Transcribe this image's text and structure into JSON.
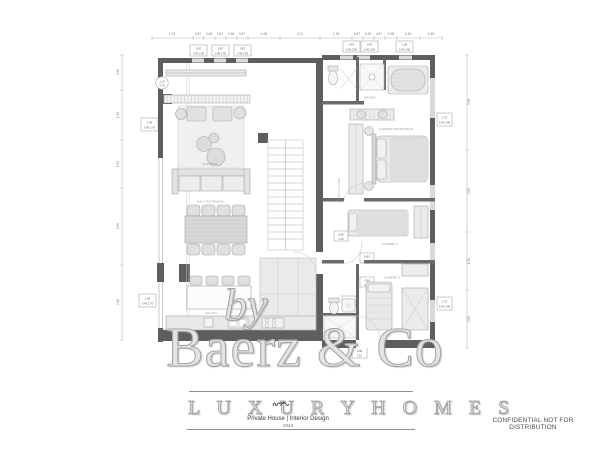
{
  "watermark": {
    "prefix": "by",
    "brand": "Baerz & Co",
    "tagline": "L U X U R Y   H O M E S"
  },
  "title_block": {
    "project": "Private House | Interior Design",
    "year": "2024"
  },
  "footer": {
    "note": "CONFIDENTIAL NOT FOR DISTRIBUTION"
  },
  "plan": {
    "room_labels": {
      "living": "SALOTTO",
      "dining": "SALA DA PRANZO",
      "kitchen": "CUCINA",
      "bath_main": "BAGNO",
      "master": "CAMERA PADRONALE",
      "closet": "WALK IN CLOSET",
      "bed2": "CAMERA 2",
      "bed3": "CAMERA 3"
    },
    "dims_top": [
      "1.10",
      "0.87",
      "0.48",
      "0.87",
      "0.48",
      "0.87",
      "1.68",
      "2.12",
      "1.75",
      "0.87",
      "0.42",
      "0.87",
      "1.08",
      "2.36",
      "0.45"
    ],
    "dims_left": [
      "3.90",
      "1.20",
      "1.55",
      "2.50",
      "2.40"
    ],
    "dims_right": [
      "3.58",
      "2.50",
      "1.50",
      "2.05"
    ],
    "window_tags": [
      {
        "l1": "0.87",
        "l2": "0.45 2.90"
      },
      {
        "l1": "0.87",
        "l2": "0.45 2.90"
      },
      {
        "l1": "0.87",
        "l2": "0.45 2.90"
      },
      {
        "l1": "0.87",
        "l2": "0.45 2.90"
      },
      {
        "l1": "0.87",
        "l2": "0.45 2.90"
      },
      {
        "l1": "1.08",
        "l2": "0.45 2.90"
      },
      {
        "l1": "1.40",
        "l2": "0.45 2.70"
      },
      {
        "l1": "1.40",
        "l2": "0.45 2.70"
      },
      {
        "l1": "1.75",
        "l2": "0.45 2.90"
      },
      {
        "l1": "1.75",
        "l2": "0.45 2.90"
      }
    ],
    "door_tags": [
      {
        "l1": "0.80",
        "l2": "2.10"
      },
      {
        "l1": "0.80",
        "l2": "2.10"
      },
      {
        "l1": "0.80",
        "l2": "2.10"
      },
      {
        "l1": "0.80",
        "l2": "2.10"
      },
      {
        "l1": "0.80",
        "l2": "2.10"
      }
    ],
    "console_tag": {
      "l1": "1.10",
      "l2": "2.75"
    },
    "colors": {
      "wall": "#5e5e5e",
      "line": "#b0b0b0",
      "furniture_fill": "#ececec",
      "glazing": "#d9d9d9"
    }
  }
}
